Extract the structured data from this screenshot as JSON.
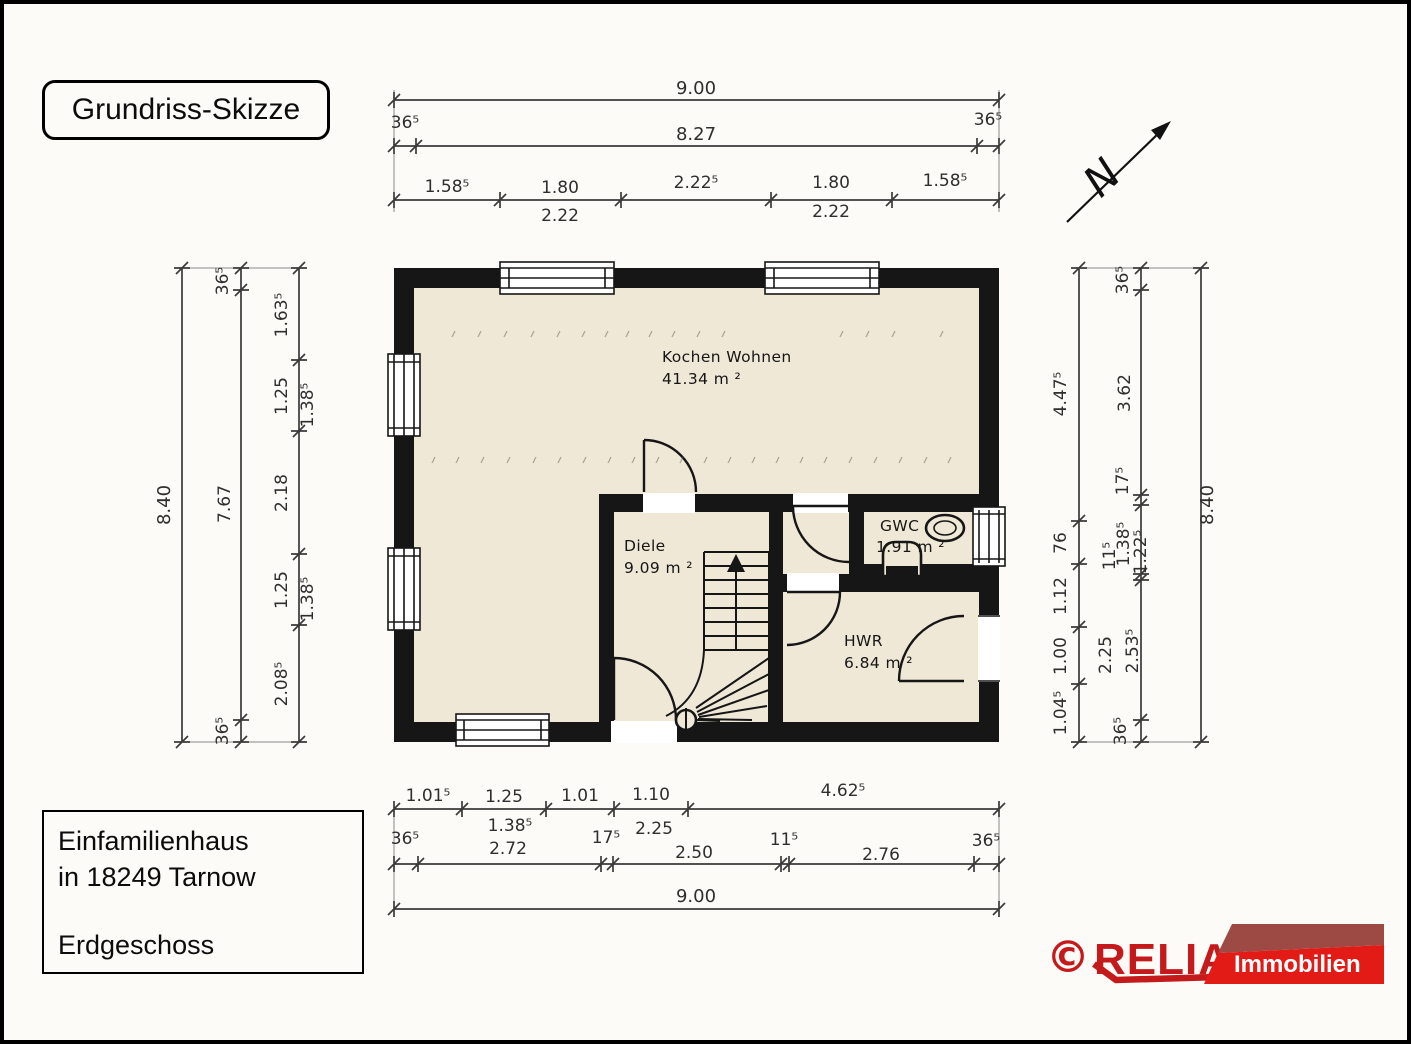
{
  "page": {
    "title_box": "Grundriss-Skizze",
    "info_box": {
      "line1": "Einfamilienhaus",
      "line2": "in 18249 Tarnow",
      "line3": "Erdgeschoss"
    }
  },
  "logo": {
    "copyright": "©",
    "brand": "RELIA",
    "banner": "Immobilien",
    "brand_color": "#c51a1b",
    "banner_color": "#e31b17",
    "banner_top_color": "#9d4a44"
  },
  "north": {
    "label": "N"
  },
  "rooms": {
    "kochen_wohnen": {
      "name": "Kochen Wohnen",
      "area": "41.34 m ²"
    },
    "diele": {
      "name": "Diele",
      "area": "9.09 m ²"
    },
    "gwc": {
      "name": "GWC",
      "area": "1.91 m ²"
    },
    "hwr": {
      "name": "HWR",
      "area": "6.84 m ²"
    }
  },
  "dims": {
    "top": {
      "total": "9.00",
      "mid": [
        "36⁵",
        "8.27",
        "36⁵"
      ],
      "inner": [
        "1.58⁵",
        "1.80",
        "2.22⁵",
        "1.80",
        "1.58⁵"
      ],
      "sub": [
        "2.22",
        "2.22"
      ]
    },
    "left": {
      "outer_total": "8.40",
      "mid": [
        "36⁵",
        "7.67",
        "36⁵"
      ],
      "inner": [
        "1.63⁵",
        "1.25",
        "2.18",
        "1.25",
        "2.08⁵"
      ],
      "sub": [
        "1.38⁵",
        "1.38⁵"
      ]
    },
    "right": {
      "outer_total": "8.40",
      "inner": [
        "4.47⁵",
        "76",
        "1.12",
        "1.00",
        "1.04⁵"
      ],
      "mid": [
        "36⁵",
        "3.62",
        "17⁵",
        "11⁵",
        "1.38⁵",
        "1.22⁵",
        "2.25",
        "2.53⁵",
        "36⁵"
      ]
    },
    "bottom": {
      "total": "9.00",
      "row1": [
        "1.01⁵",
        "1.25",
        "1.01",
        "1.10",
        "4.62⁵"
      ],
      "row1_sub": [
        "1.38⁵",
        "2.25"
      ],
      "row2": [
        "36⁵",
        "2.72",
        "17⁵",
        "2.50",
        "11⁵",
        "2.76",
        "36⁵"
      ]
    }
  }
}
